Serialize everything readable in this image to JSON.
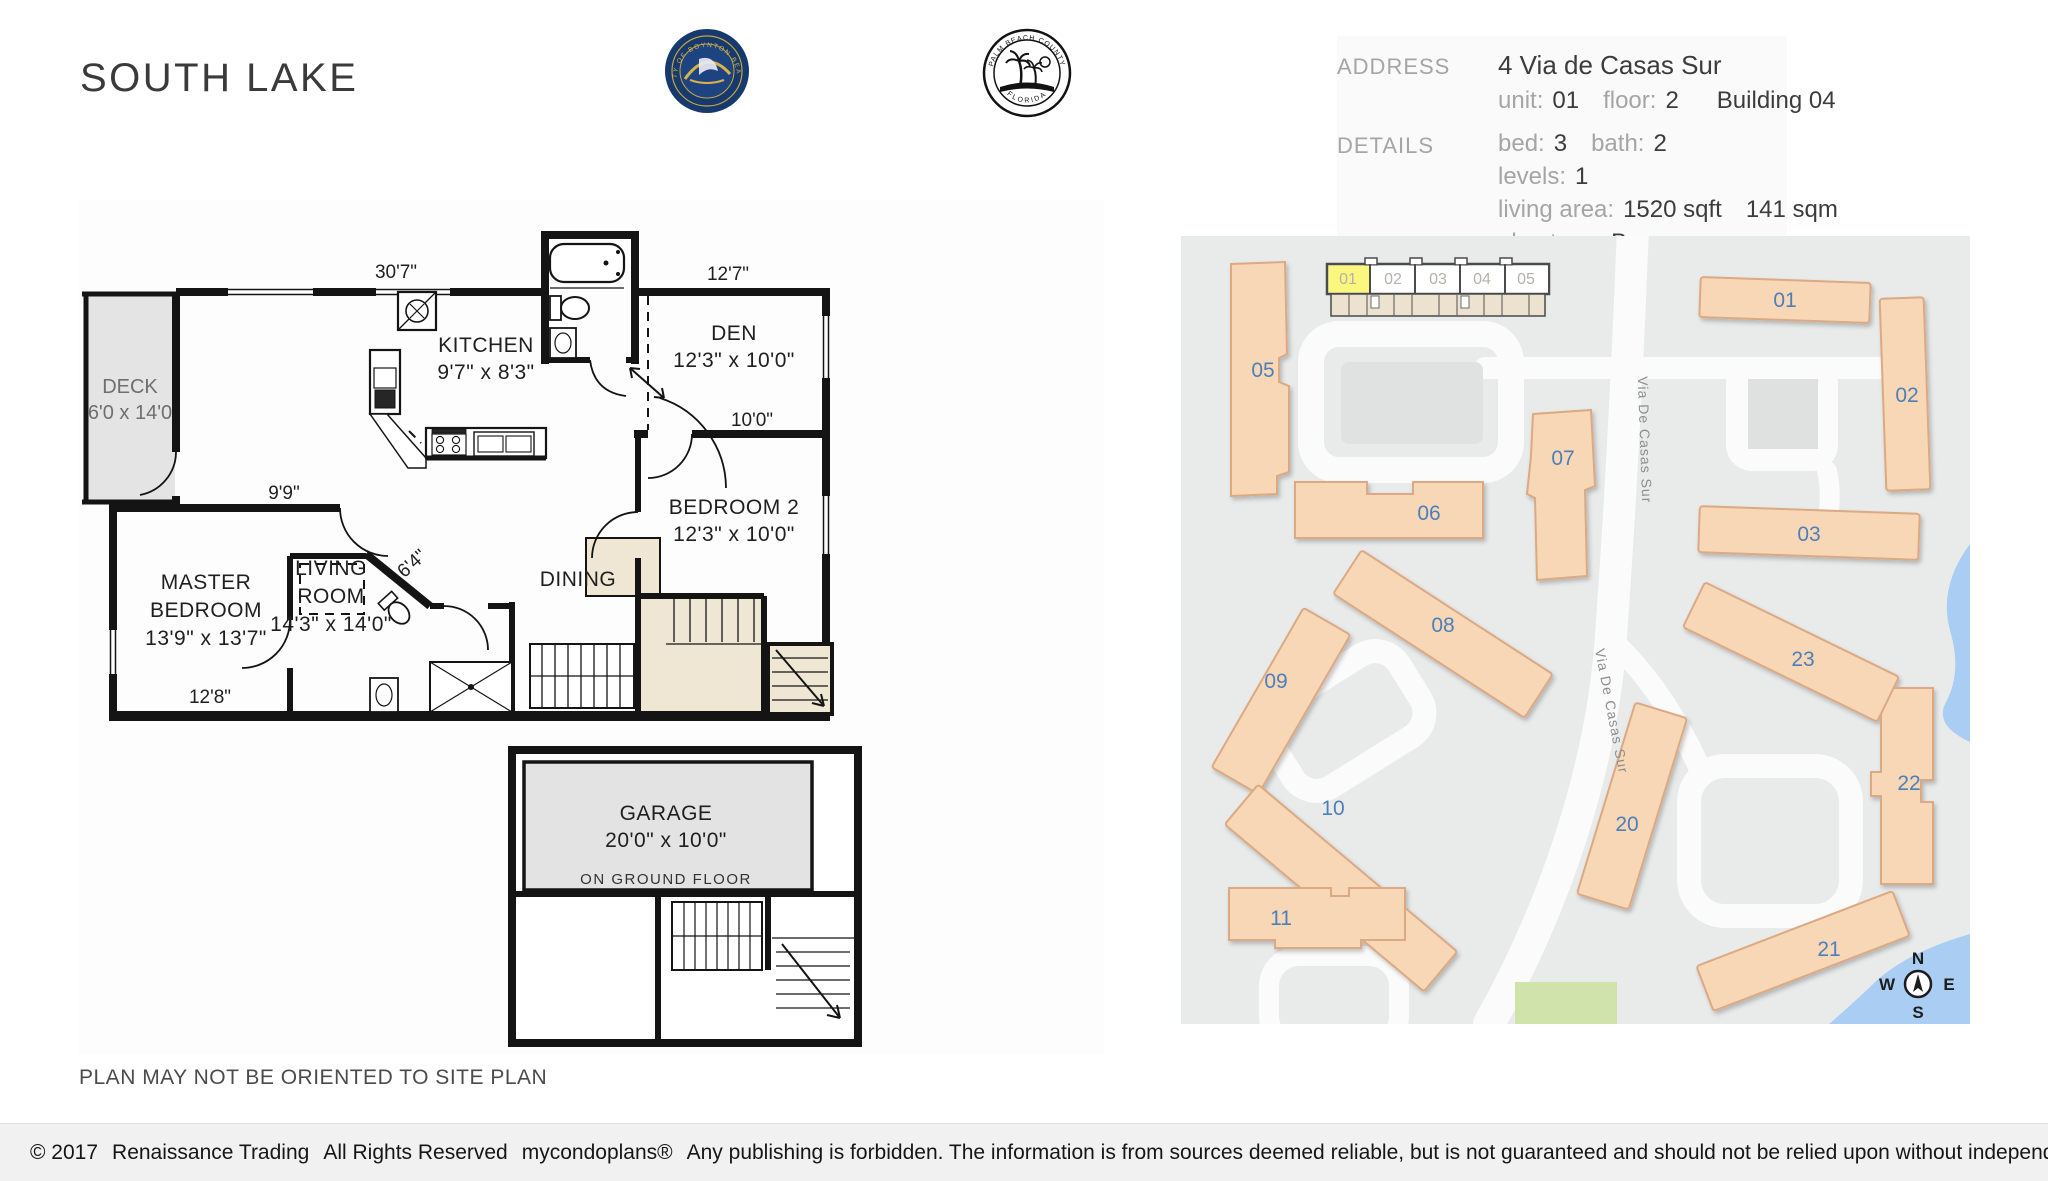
{
  "title": "SOUTH LAKE",
  "logos": {
    "boynton_ring_text": "CITY OF BOYNTON BEACH",
    "palm_top_text": "PALM BEACH COUNTY",
    "palm_bottom_text": "FLORIDA"
  },
  "info": {
    "address_label": "ADDRESS",
    "address_value": "4  Via de Casas Sur",
    "unit_label": "unit:",
    "unit_value": "01",
    "floor_label": "floor:",
    "floor_value": "2",
    "building_value": "Building 04",
    "details_label": "DETAILS",
    "bed_label": "bed:",
    "bed_value": "3",
    "bath_label": "bath:",
    "bath_value": "2",
    "levels_label": "levels:",
    "levels_value": "1",
    "living_area_label": "living area:",
    "living_area_sqft": "1520 sqft",
    "living_area_sqm": "141 sqm",
    "plan_type_label": "plan type:",
    "plan_type_value": "B"
  },
  "floorplan": {
    "deck_name": "DECK",
    "deck_dim": "6'0 x 14'0",
    "living_1": "LIVING",
    "living_2": "ROOM",
    "living_dim": "14'3\" x 14'0\"",
    "kitchen_name": "KITCHEN",
    "kitchen_dim": "9'7\" x 8'3\"",
    "den_name": "DEN",
    "den_dim": "12'3\" x 10'0\"",
    "bed2_name": "BEDROOM 2",
    "bed2_dim": "12'3\" x 10'0\"",
    "master_1": "MASTER",
    "master_2": "BEDROOM",
    "master_dim": "13'9\" x 13'7\"",
    "dining_name": "DINING",
    "garage_name": "GARAGE",
    "garage_dim": "20'0\" x 10'0\"",
    "garage_note": "ON GROUND FLOOR",
    "dim_top": "30'7\"",
    "dim_topright": "12'7\"",
    "dim_right": "10'0\"",
    "dim_mid": "9'9\"",
    "dim_diag": "6'4\"",
    "dim_bottom": "12'8\"",
    "disclaimer": "PLAN MAY NOT BE ORIENTED TO SITE PLAN"
  },
  "sitemap": {
    "units": [
      {
        "label": "01"
      },
      {
        "label": "02"
      },
      {
        "label": "03"
      },
      {
        "label": "04"
      },
      {
        "label": "05"
      }
    ],
    "highlighted_unit": "01",
    "street_label": "Via De Casas Sur",
    "buildings": [
      {
        "id": "01"
      },
      {
        "id": "02"
      },
      {
        "id": "03"
      },
      {
        "id": "05"
      },
      {
        "id": "06"
      },
      {
        "id": "07"
      },
      {
        "id": "08"
      },
      {
        "id": "09"
      },
      {
        "id": "10"
      },
      {
        "id": "11"
      },
      {
        "id": "20"
      },
      {
        "id": "21"
      },
      {
        "id": "22"
      },
      {
        "id": "23"
      }
    ],
    "compass": {
      "n": "N",
      "e": "E",
      "s": "S",
      "w": "W"
    }
  },
  "footer": {
    "copyright": "© 2017",
    "company": "Renaissance Trading",
    "rights": "All Rights Reserved",
    "brand": "mycondoplans®",
    "disclaimer": "Any publishing is forbidden.  The information is from sources deemed reliable, but is not guaranteed and should not be relied upon without independent verification."
  }
}
